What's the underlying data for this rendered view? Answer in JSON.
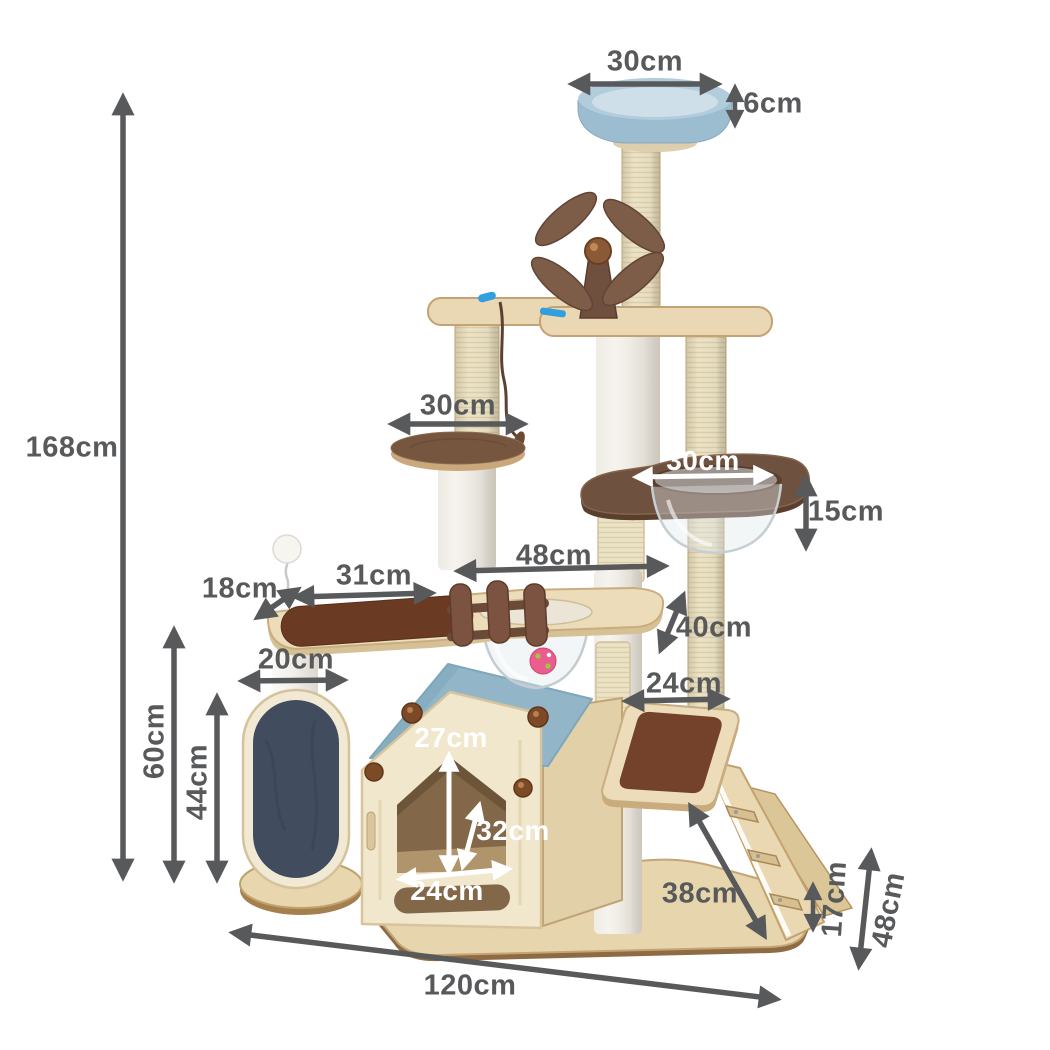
{
  "dimensions": {
    "top_perch_width": "30cm",
    "top_perch_height": "6cm",
    "total_height": "168cm",
    "round_platform_width": "30cm",
    "capsule_opening_width": "30cm",
    "capsule_depth": "15cm",
    "upper_platform_width": "48cm",
    "left_perch_length": "31cm",
    "left_perch_depth": "18cm",
    "platform_to_step_height": "40cm",
    "scratcher_post_width": "20cm",
    "step_platform_width": "24cm",
    "scratcher_total_height": "60cm",
    "scratcher_pad_height": "44cm",
    "house_door_height": "27cm",
    "house_interior_diagonal": "32cm",
    "house_door_width": "24cm",
    "ramp_length": "38cm",
    "ramp_step_height": "17cm",
    "base_depth": "48cm",
    "base_width": "120cm"
  },
  "colors": {
    "annotation_gray": "#58595b",
    "annotation_white": "#ffffff",
    "perch_blue": "#9cbccf",
    "roof_blue": "#92b6c8",
    "wood_light": "#ecdcb8",
    "wood_walnut": "#6f5140",
    "carpet_brown": "#6a3a22",
    "carpet_navy": "#414d5f",
    "sisal_cream": "#ece2c6",
    "ball_pink": "#ea5d8e"
  }
}
